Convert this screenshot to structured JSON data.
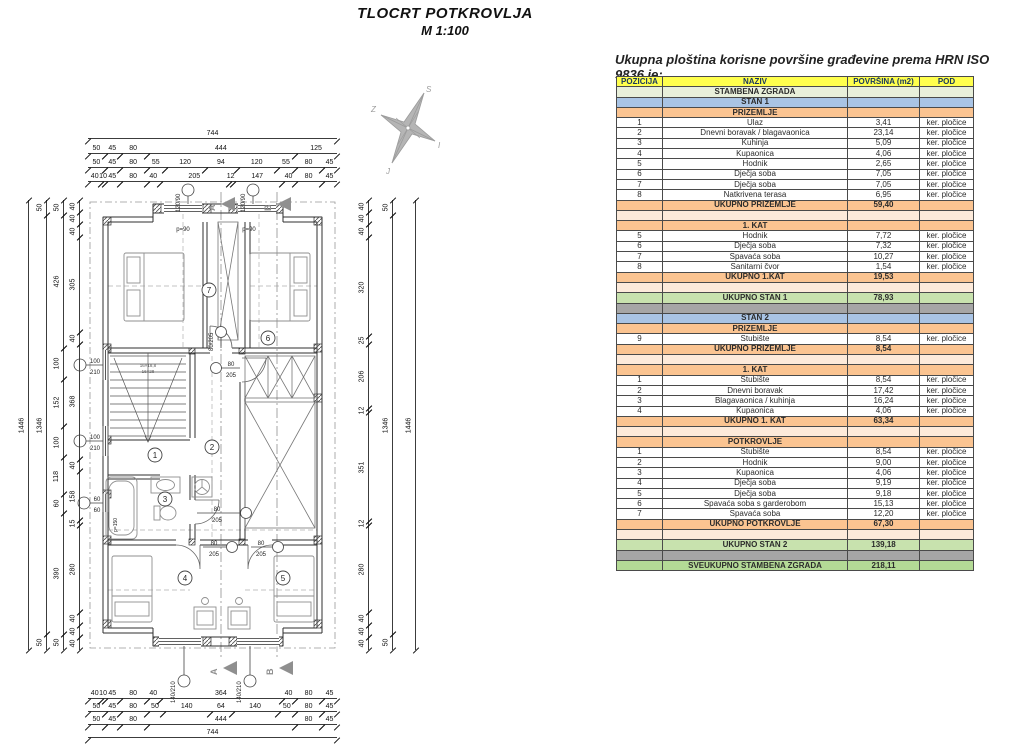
{
  "title": {
    "line1": "TLOCRT POTKROVLJA",
    "line2": "M 1:100"
  },
  "caption": "Ukupna ploština korisne površine građevine prema HRN ISO 9836 je:",
  "table": {
    "columns": [
      "POZICIJA",
      "NAZIV",
      "POVRŠINA (m2)",
      "POD"
    ],
    "rows": [
      {
        "type": "building",
        "pozicija": "",
        "naziv": "STAMBENA ZGRADA",
        "povrsina": "",
        "pod": ""
      },
      {
        "type": "stan",
        "pozicija": "",
        "naziv": "STAN 1",
        "povrsina": "",
        "pod": ""
      },
      {
        "type": "floor",
        "pozicija": "",
        "naziv": "PRIZEMLJE",
        "povrsina": "",
        "pod": ""
      },
      {
        "type": "data",
        "pozicija": "1",
        "naziv": "Ulaz",
        "povrsina": "3,41",
        "pod": "ker. pločice"
      },
      {
        "type": "data",
        "pozicija": "2",
        "naziv": "Dnevni boravak / blagavaonica",
        "povrsina": "23,14",
        "pod": "ker. pločice"
      },
      {
        "type": "data",
        "pozicija": "3",
        "naziv": "Kuhinja",
        "povrsina": "5,09",
        "pod": "ker. pločice"
      },
      {
        "type": "data",
        "pozicija": "4",
        "naziv": "Kupaonica",
        "povrsina": "4,06",
        "pod": "ker. pločice"
      },
      {
        "type": "data",
        "pozicija": "5",
        "naziv": "Hodnik",
        "povrsina": "2,65",
        "pod": "ker. pločice"
      },
      {
        "type": "data",
        "pozicija": "6",
        "naziv": "Dječja soba",
        "povrsina": "7,05",
        "pod": "ker. pločice"
      },
      {
        "type": "data",
        "pozicija": "7",
        "naziv": "Dječja soba",
        "povrsina": "7,05",
        "pod": "ker. pločice"
      },
      {
        "type": "data",
        "pozicija": "8",
        "naziv": "Natkrivena terasa",
        "povrsina": "6,95",
        "pod": "ker. pločice"
      },
      {
        "type": "total",
        "pozicija": "",
        "naziv": "UKUPNO PRIZEMLJE",
        "povrsina": "59,40",
        "pod": ""
      },
      {
        "type": "spacer",
        "pozicija": "",
        "naziv": "",
        "povrsina": "",
        "pod": ""
      },
      {
        "type": "floor",
        "pozicija": "",
        "naziv": "1. KAT",
        "povrsina": "",
        "pod": ""
      },
      {
        "type": "data",
        "pozicija": "5",
        "naziv": "Hodnik",
        "povrsina": "7,72",
        "pod": "ker. pločice"
      },
      {
        "type": "data",
        "pozicija": "6",
        "naziv": "Dječja soba",
        "povrsina": "7,32",
        "pod": "ker. pločice"
      },
      {
        "type": "data",
        "pozicija": "7",
        "naziv": "Spavaća soba",
        "povrsina": "10,27",
        "pod": "ker. pločice"
      },
      {
        "type": "data",
        "pozicija": "8",
        "naziv": "Sanitarni čvor",
        "povrsina": "1,54",
        "pod": "ker. pločice"
      },
      {
        "type": "total",
        "pozicija": "",
        "naziv": "UKUPNO 1.KAT",
        "povrsina": "19,53",
        "pod": ""
      },
      {
        "type": "spacer",
        "pozicija": "",
        "naziv": "",
        "povrsina": "",
        "pod": ""
      },
      {
        "type": "grand",
        "pozicija": "",
        "naziv": "UKUPNO STAN 1",
        "povrsina": "78,93",
        "pod": ""
      },
      {
        "type": "gray",
        "pozicija": "",
        "naziv": "",
        "povrsina": "",
        "pod": ""
      },
      {
        "type": "stan",
        "pozicija": "",
        "naziv": "STAN 2",
        "povrsina": "",
        "pod": ""
      },
      {
        "type": "floor",
        "pozicija": "",
        "naziv": "PRIZEMLJE",
        "povrsina": "",
        "pod": ""
      },
      {
        "type": "data",
        "pozicija": "9",
        "naziv": "Stubište",
        "povrsina": "8,54",
        "pod": "ker. pločice"
      },
      {
        "type": "total",
        "pozicija": "",
        "naziv": "UKUPNO PRIZEMLJE",
        "povrsina": "8,54",
        "pod": ""
      },
      {
        "type": "spacer",
        "pozicija": "",
        "naziv": "",
        "povrsina": "",
        "pod": ""
      },
      {
        "type": "floor",
        "pozicija": "",
        "naziv": "1. KAT",
        "povrsina": "",
        "pod": ""
      },
      {
        "type": "data",
        "pozicija": "1",
        "naziv": "Stubište",
        "povrsina": "8,54",
        "pod": "ker. pločice"
      },
      {
        "type": "data",
        "pozicija": "2",
        "naziv": "Dnevni boravak",
        "povrsina": "17,42",
        "pod": "ker. pločice"
      },
      {
        "type": "data",
        "pozicija": "3",
        "naziv": "Blagavaonica / kuhinja",
        "povrsina": "16,24",
        "pod": "ker. pločice"
      },
      {
        "type": "data",
        "pozicija": "4",
        "naziv": "Kupaonica",
        "povrsina": "4,06",
        "pod": "ker. pločice"
      },
      {
        "type": "total",
        "pozicija": "",
        "naziv": "UKUPNO 1. KAT",
        "povrsina": "63,34",
        "pod": ""
      },
      {
        "type": "spacer",
        "pozicija": "",
        "naziv": "",
        "povrsina": "",
        "pod": ""
      },
      {
        "type": "floor",
        "pozicija": "",
        "naziv": "POTKROVLJE",
        "povrsina": "",
        "pod": ""
      },
      {
        "type": "data",
        "pozicija": "1",
        "naziv": "Stubište",
        "povrsina": "8,54",
        "pod": "ker. pločice"
      },
      {
        "type": "data",
        "pozicija": "2",
        "naziv": "Hodnik",
        "povrsina": "9,00",
        "pod": "ker. pločice"
      },
      {
        "type": "data",
        "pozicija": "3",
        "naziv": "Kupaonica",
        "povrsina": "4,06",
        "pod": "ker. pločice"
      },
      {
        "type": "data",
        "pozicija": "4",
        "naziv": "Dječja soba",
        "povrsina": "9,19",
        "pod": "ker. pločice"
      },
      {
        "type": "data",
        "pozicija": "5",
        "naziv": "Dječja soba",
        "povrsina": "9,18",
        "pod": "ker. pločice"
      },
      {
        "type": "data",
        "pozicija": "6",
        "naziv": "Spavaća soba s garderobom",
        "povrsina": "15,13",
        "pod": "ker. pločice"
      },
      {
        "type": "data",
        "pozicija": "7",
        "naziv": "Spavaća soba",
        "povrsina": "12,20",
        "pod": "ker. pločice"
      },
      {
        "type": "total",
        "pozicija": "",
        "naziv": "UKUPNO POTKROVLJE",
        "povrsina": "67,30",
        "pod": ""
      },
      {
        "type": "spacer",
        "pozicija": "",
        "naziv": "",
        "povrsina": "",
        "pod": ""
      },
      {
        "type": "grand",
        "pozicija": "",
        "naziv": "UKUPNO STAN 2",
        "povrsina": "139,18",
        "pod": ""
      },
      {
        "type": "gray",
        "pozicija": "",
        "naziv": "",
        "povrsina": "",
        "pod": ""
      },
      {
        "type": "grand2",
        "pozicija": "",
        "naziv": "SVEUKUPNO STAMBENA ZGRADA",
        "povrsina": "218,11",
        "pod": ""
      }
    ]
  },
  "dims": {
    "top1": [
      "744"
    ],
    "top2": [
      "50",
      "45",
      "80",
      "444",
      "125"
    ],
    "top3": [
      "50",
      "45",
      "80",
      "55",
      "120",
      "94",
      "120",
      "55",
      "80",
      "45"
    ],
    "top4": [
      "40",
      "10",
      "45",
      "80",
      "40",
      "205",
      "12",
      "147",
      "40",
      "80",
      "45"
    ],
    "bot1": [
      "40",
      "10",
      "45",
      "80",
      "40",
      "364",
      "40",
      "80",
      "45"
    ],
    "bot2": [
      "50",
      "45",
      "80",
      "50",
      "140",
      "64",
      "140",
      "50",
      "80",
      "45"
    ],
    "bot3": [
      "50",
      "45",
      "80",
      "444",
      "80",
      "45"
    ],
    "bot4": [
      "744"
    ],
    "left1": [
      "1446"
    ],
    "left2": [
      "50",
      "1346",
      "50"
    ],
    "left3": [
      "50",
      "426",
      "100",
      "152",
      "100",
      "118",
      "60",
      "390",
      "50"
    ],
    "left4": [
      "40",
      "40",
      "40",
      "305",
      "40",
      "368",
      "40",
      "158",
      "15",
      "280",
      "40",
      "40",
      "40"
    ],
    "right1": [
      "40",
      "40",
      "40",
      "320",
      "25",
      "206",
      "12",
      "351",
      "12",
      "280",
      "40",
      "40",
      "40"
    ],
    "right2": [
      "50",
      "1346",
      "50"
    ],
    "right3": [
      "1446"
    ]
  },
  "plan": {
    "room_numbers": [
      "1",
      "2",
      "3",
      "4",
      "5",
      "6",
      "7"
    ],
    "section_a": "A",
    "section_b": "B",
    "compass": {
      "n": "S",
      "e": "I",
      "s": "J",
      "w": "Z"
    },
    "window_top": "120/90",
    "window_bottom": "140/210",
    "window_stair": {
      "w": "100",
      "h": "210"
    },
    "window_bath": {
      "w": "60",
      "h": "60"
    },
    "door": {
      "w": "80",
      "h": "205",
      "label": "80/205"
    },
    "parapet": "p=90",
    "parapet_bath": "p=150",
    "stairs_1": "16×18,8",
    "stairs_2": "16×28"
  }
}
